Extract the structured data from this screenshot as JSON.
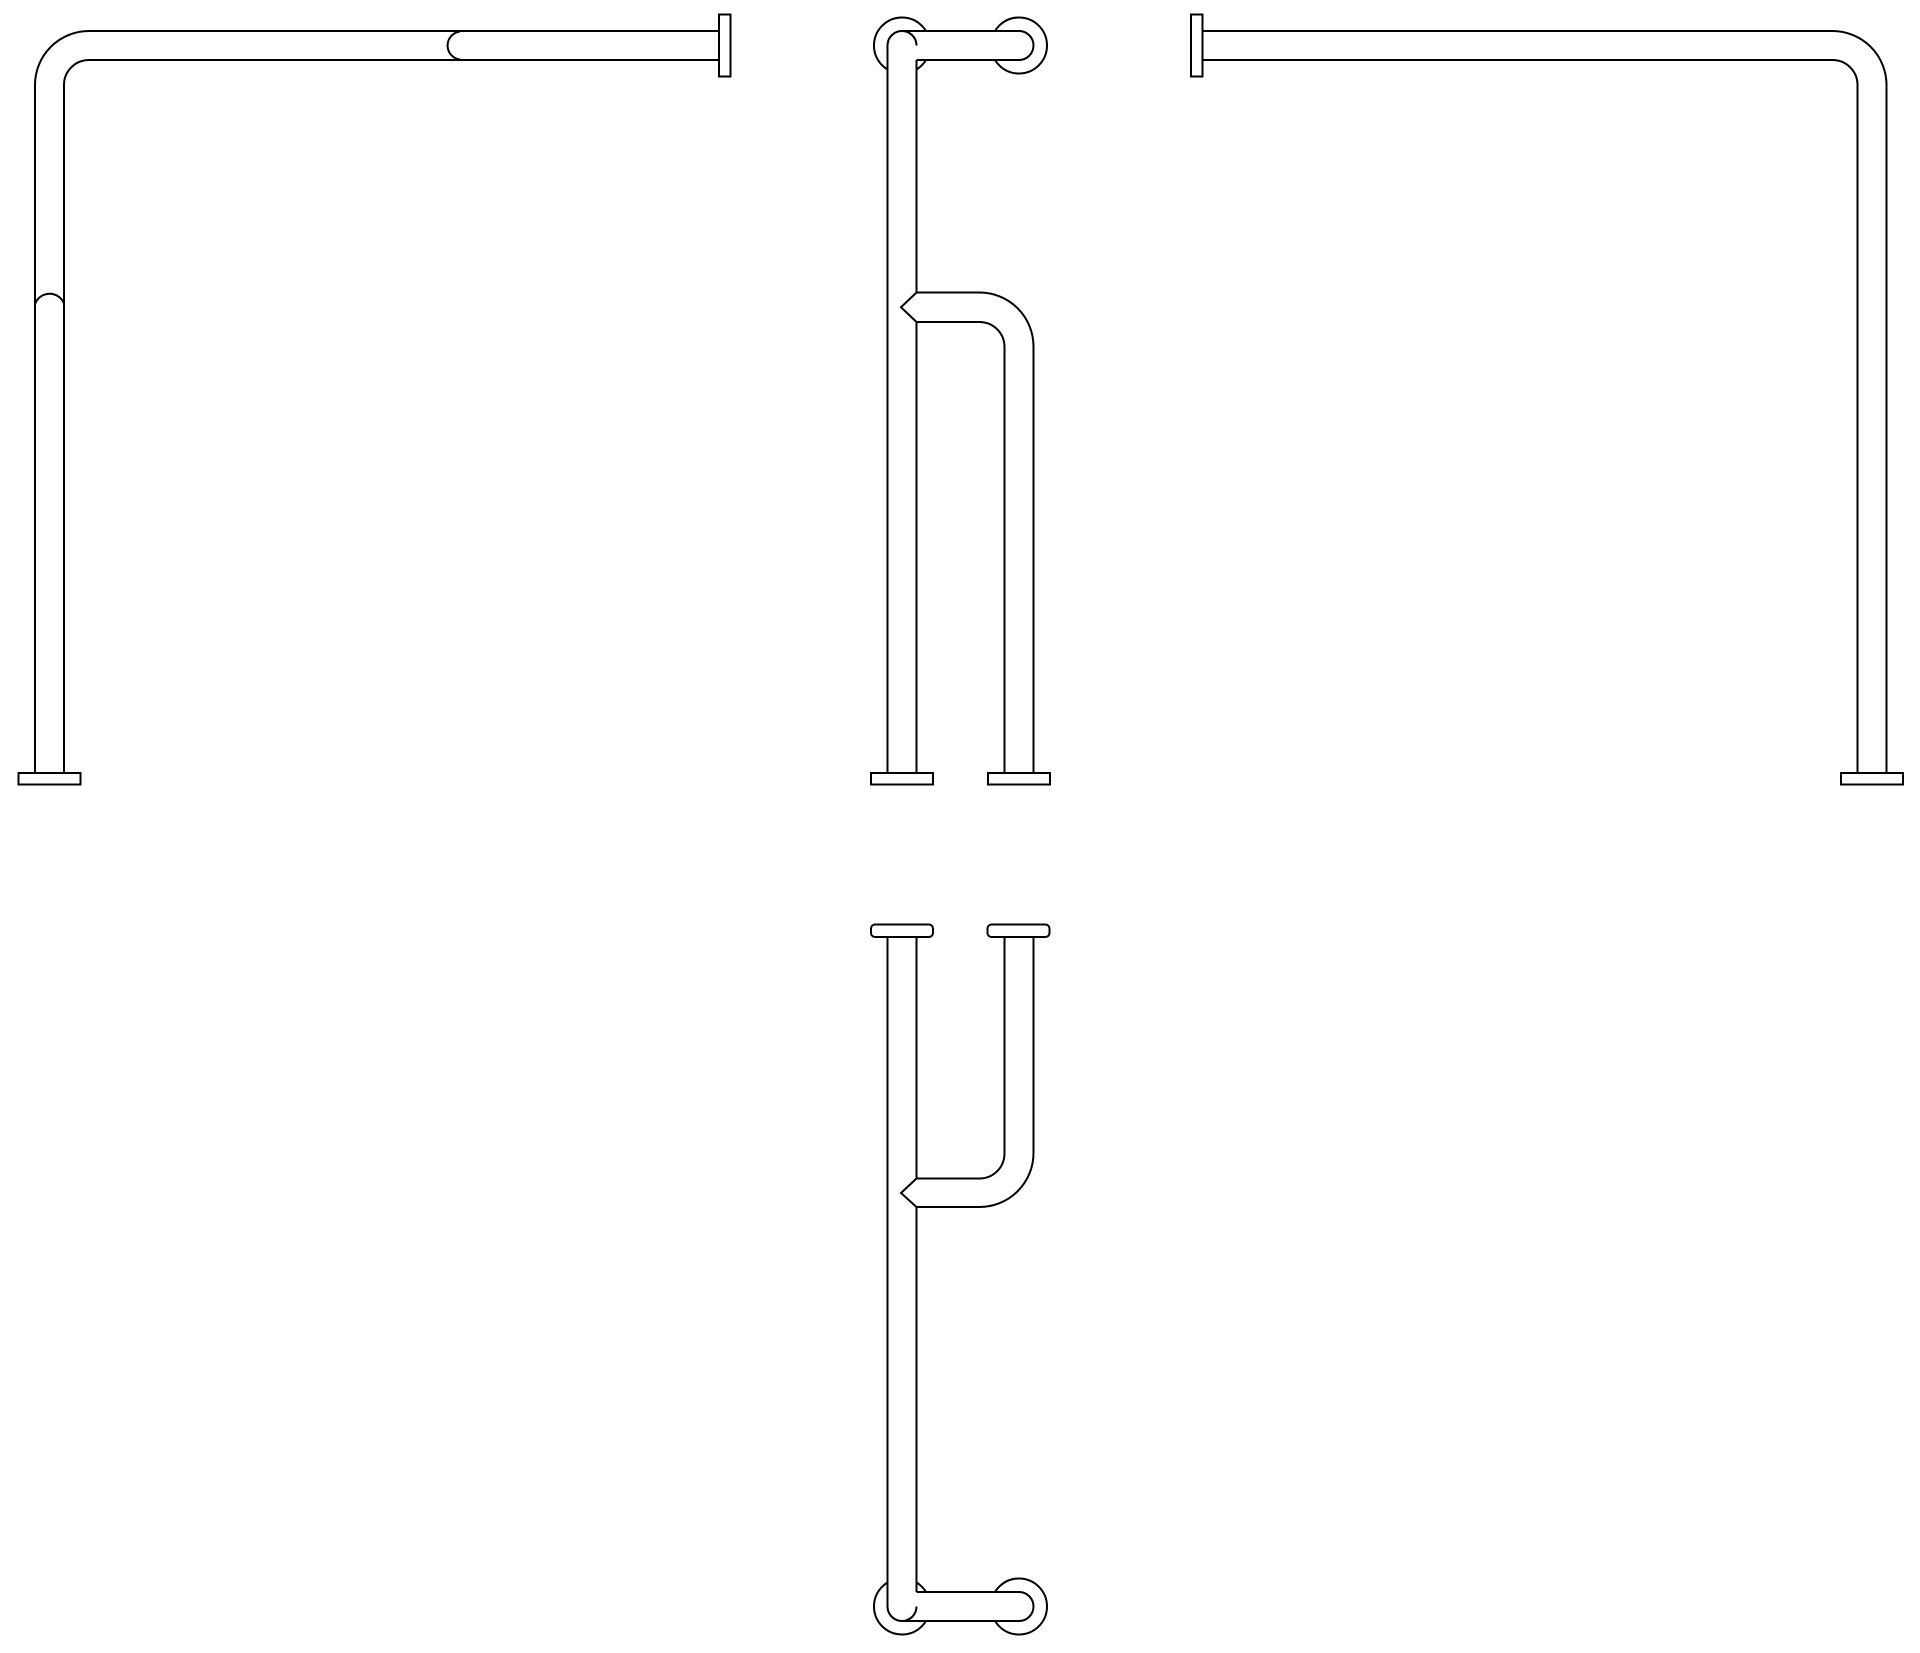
{
  "canvas": {
    "width": 1920,
    "height": 1653,
    "background": "#ffffff",
    "line_color": "#000000",
    "line_width": 2
  },
  "drawing": {
    "kind": "grab-bar-orthographic-views",
    "view_count": 4
  },
  "views": [
    {
      "id": "left-elevation-view",
      "elements": [
        {
          "t": "path",
          "d": "M 89 31 H 719"
        },
        {
          "t": "path",
          "d": "M 89 60 H 719"
        },
        {
          "t": "path",
          "d": "M 35 85 A 54 54 0 0 1 89 31"
        },
        {
          "t": "path",
          "d": "M 64 85 A 25 25 0 0 1 89 60"
        },
        {
          "t": "path",
          "d": "M 35 85 V 773"
        },
        {
          "t": "path",
          "d": "M 64 85 V 773"
        },
        {
          "t": "path",
          "d": "M 460 31.5 A 14.1 14.1 0 0 0 460 59.5"
        },
        {
          "t": "path",
          "d": "M 35 304 A 15.5 15.5 0 0 1 64 303.5"
        },
        {
          "t": "rect",
          "x": 719,
          "y": 14.5,
          "w": 11.5,
          "h": 62
        },
        {
          "t": "rect",
          "x": 18.5,
          "y": 773,
          "w": 62,
          "h": 11.5
        }
      ]
    },
    {
      "id": "side-elevation-view",
      "elements": [
        {
          "t": "circle",
          "cx": 902,
          "cy": 45.5,
          "r": 28
        },
        {
          "t": "circle",
          "cx": 1019,
          "cy": 45.5,
          "r": 28
        },
        {
          "t": "fill",
          "d": "M 887.5 45.5 A 14.5 14.5 0 0 1 916.5 45.5 V 773 H 887.5 Z"
        },
        {
          "t": "fill",
          "d": "M 902 31 H 1019 A 14.5 14.5 0 0 1 1019 60 H 902 Z"
        },
        {
          "t": "path",
          "d": "M 887.5 45.5 A 14.5 14.5 0 0 1 916.5 45.5"
        },
        {
          "t": "path",
          "d": "M 902 31 H 1019"
        },
        {
          "t": "path",
          "d": "M 1019 31 A 14.5 14.5 0 0 1 1019 60"
        },
        {
          "t": "path",
          "d": "M 916.5 60 H 1019"
        },
        {
          "t": "path",
          "d": "M 887.5 45.5 V 773"
        },
        {
          "t": "path",
          "d": "M 916.5 60 V 292.5"
        },
        {
          "t": "path",
          "d": "M 916.5 292.5 L 901 307.25 L 916.5 322"
        },
        {
          "t": "path",
          "d": "M 916.5 322 V 773"
        },
        {
          "t": "path",
          "d": "M 916.5 292.5 H 979.5 A 54 54 0 0 1 1033.5 346.5 V 773"
        },
        {
          "t": "path",
          "d": "M 916.5 322 H 979.5 A 25 25 0 0 1 1004.5 347 V 773"
        },
        {
          "t": "rect",
          "x": 871,
          "y": 773,
          "w": 62,
          "h": 11.5
        },
        {
          "t": "rect",
          "x": 988,
          "y": 773,
          "w": 62,
          "h": 11.5
        }
      ]
    },
    {
      "id": "right-elevation-view",
      "elements": [
        {
          "t": "path",
          "d": "M 1202.5 31 H 1832.5 A 54 54 0 0 1 1886.5 85 V 773"
        },
        {
          "t": "path",
          "d": "M 1202.5 60 H 1832.5 A 25 25 0 0 1 1857.5 85 V 773"
        },
        {
          "t": "rect",
          "x": 1191,
          "y": 14.5,
          "w": 11.5,
          "h": 62
        },
        {
          "t": "rect",
          "x": 1841,
          "y": 773,
          "w": 62,
          "h": 11.5
        }
      ]
    },
    {
      "id": "plan-view",
      "elements": [
        {
          "t": "circle",
          "cx": 902,
          "cy": 1606.5,
          "r": 28
        },
        {
          "t": "circle",
          "cx": 1019,
          "cy": 1606.5,
          "r": 28
        },
        {
          "t": "fill",
          "d": "M 887.5 937 H 916.5 V 1606.5 A 14.5 14.5 0 0 1 887.5 1606.5 Z"
        },
        {
          "t": "fill",
          "d": "M 902 1592 H 1019 A 14.5 14.5 0 0 1 1019 1621 H 902 Z"
        },
        {
          "t": "path",
          "d": "M 887.5 937 V 1606.5"
        },
        {
          "t": "path",
          "d": "M 887.5 1606.5 A 14.5 14.5 0 0 0 916.5 1606.5"
        },
        {
          "t": "path",
          "d": "M 916.5 937 V 1178.5"
        },
        {
          "t": "path",
          "d": "M 916.5 1178.5 L 901 1193 L 916.5 1207"
        },
        {
          "t": "path",
          "d": "M 916.5 1207 V 1592"
        },
        {
          "t": "path",
          "d": "M 916.5 1592 H 1019"
        },
        {
          "t": "path",
          "d": "M 1019 1592 A 14.5 14.5 0 0 1 1019 1621"
        },
        {
          "t": "path",
          "d": "M 902 1621 H 1019"
        },
        {
          "t": "path",
          "d": "M 1004.5 937 V 1153.5 A 25 25 0 0 1 979.5 1178.5 H 916.5"
        },
        {
          "t": "path",
          "d": "M 1033.5 937 V 1153 A 54 54 0 0 1 979.5 1207 H 916.5"
        },
        {
          "t": "rect",
          "x": 871,
          "y": 924.5,
          "w": 62,
          "h": 12.5,
          "rx": 4
        },
        {
          "t": "rect",
          "x": 987.5,
          "y": 924.5,
          "w": 62,
          "h": 12.5,
          "rx": 4
        }
      ]
    }
  ]
}
